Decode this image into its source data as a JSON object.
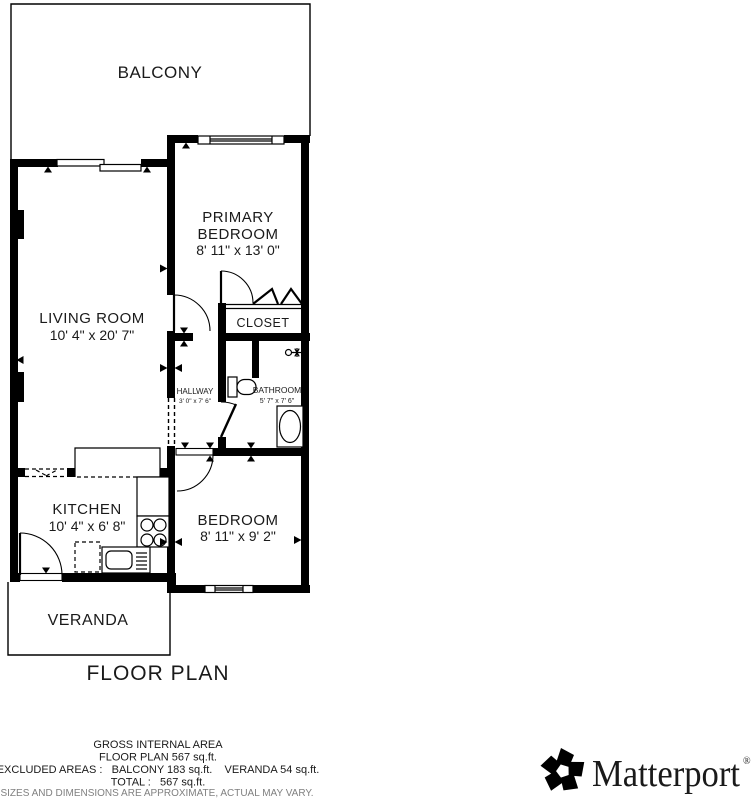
{
  "plan": {
    "title": "FLOOR PLAN",
    "rooms": {
      "balcony": {
        "name": "BALCONY"
      },
      "living_room": {
        "name": "LIVING ROOM",
        "dims": "10' 4\" x 20' 7\""
      },
      "primary_bedroom": {
        "name_line1": "PRIMARY",
        "name_line2": "BEDROOM",
        "dims": "8' 11\" x 13' 0\""
      },
      "closet": {
        "name": "CLOSET"
      },
      "hallway": {
        "name": "HALLWAY",
        "dims": "3' 0\" x 7' 6\""
      },
      "bathroom": {
        "name": "BATHROOM",
        "dims": "5' 7\" x 7' 6\""
      },
      "kitchen": {
        "name": "KITCHEN",
        "dims": "10' 4\" x 6' 8\""
      },
      "bedroom": {
        "name": "BEDROOM",
        "dims": "8' 11\" x 9' 2\""
      },
      "veranda": {
        "name": "VERANDA"
      }
    },
    "footer": {
      "line1": "GROSS INTERNAL AREA",
      "line2": "FLOOR PLAN 567 sq.ft.",
      "line3": "EXCLUDED AREAS :   BALCONY 183 sq.ft.    VERANDA 54 sq.ft.",
      "line4": "TOTAL :   567 sq.ft.",
      "disclaimer": "SIZES AND DIMENSIONS ARE APPROXIMATE, ACTUAL MAY VARY."
    },
    "brand": {
      "wordmark": "Matterport",
      "registered": "®"
    },
    "colors": {
      "wall": "#000000",
      "text": "#1a1a1a",
      "muted": "#808080",
      "bg": "#ffffff"
    }
  }
}
